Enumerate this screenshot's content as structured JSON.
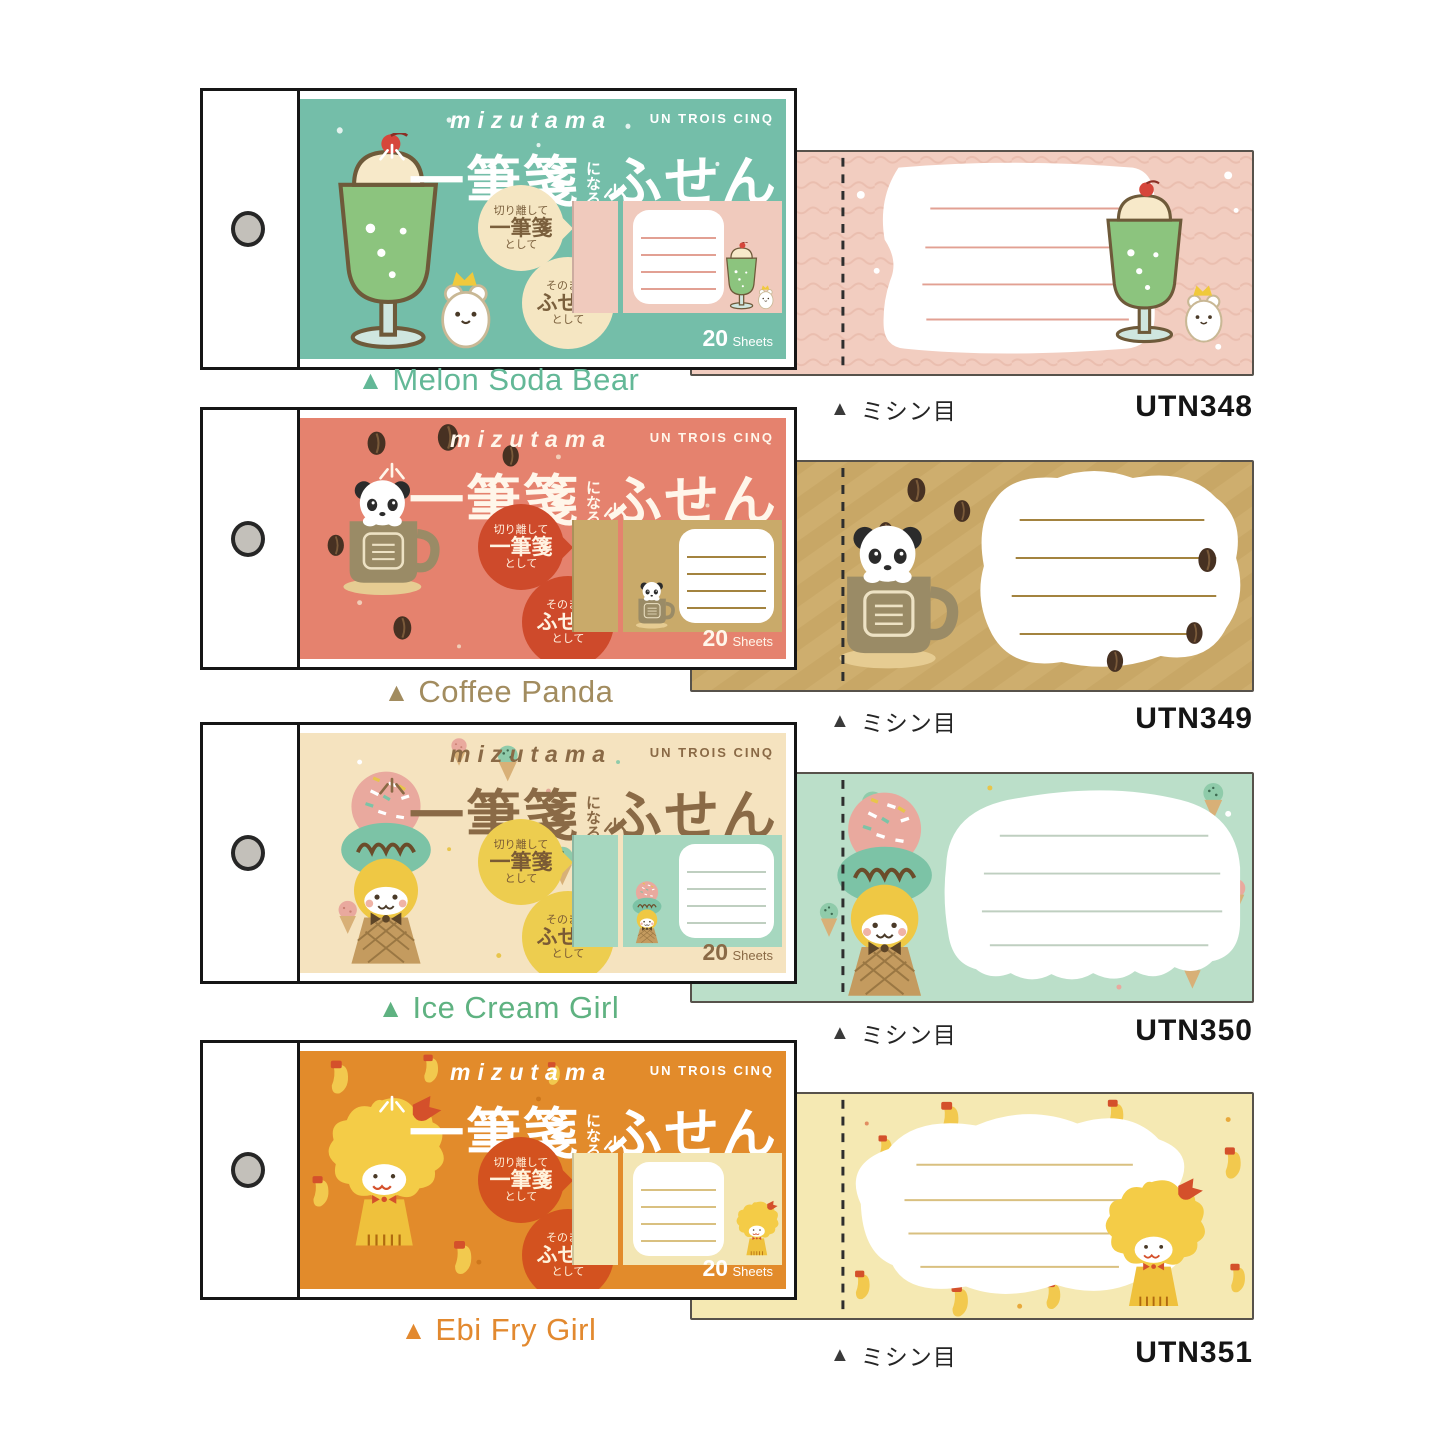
{
  "icons": {
    "triangle": "▲",
    "sparkle": "sparkle-rays",
    "binding_hole": "punch-hole"
  },
  "brand": {
    "logo": "mizutama",
    "collection": "UN TROIS CINQ"
  },
  "cover": {
    "title_part1": "一筆箋",
    "title_connector": "になる",
    "title_part2": "ふせん",
    "bubble1_line1": "切り離して",
    "bubble1_line2": "一筆箋",
    "bubble1_line3": "として",
    "bubble2_line1": "そのまま",
    "bubble2_line2": "ふせん",
    "bubble2_line3": "として",
    "sheets_count": "20",
    "sheets_label": "Sheets"
  },
  "note": {
    "perforation_label": "ミシン目"
  },
  "products": [
    {
      "name": "Melon Soda Bear",
      "code": "UTN348",
      "colors": {
        "cover_bg": "#74BEA9",
        "ink": "#FFFFFF",
        "bubble_bg": "#F5E6C2",
        "bubble_ink": "#7A5F3C",
        "label": "#63B897",
        "note_bg": "#F2CDC0",
        "note_line": "#E2A093",
        "preview_bg": "#F0CABD"
      }
    },
    {
      "name": "Coffee Panda",
      "code": "UTN349",
      "colors": {
        "cover_bg": "#E5826E",
        "ink": "#FFF6EA",
        "bubble_bg": "#CE4A2B",
        "bubble_ink": "#FFF3E2",
        "label": "#A28C5F",
        "note_bg": "#C8A766",
        "note_line": "#A3833F",
        "preview_bg": "#C9AA6A"
      }
    },
    {
      "name": "Ice Cream Girl",
      "code": "UTN350",
      "colors": {
        "cover_bg": "#F5E3BF",
        "ink": "#8A6A46",
        "bubble_bg": "#EDCD4F",
        "bubble_ink": "#7A5A35",
        "label": "#5FB281",
        "note_bg": "#BBDFC9",
        "note_line": "#BFCFC0",
        "preview_bg": "#A6D7BF"
      }
    },
    {
      "name": "Ebi Fry Girl",
      "code": "UTN351",
      "colors": {
        "cover_bg": "#E28B2B",
        "ink": "#FFFFFF",
        "bubble_bg": "#D3521F",
        "bubble_ink": "#FFF3DC",
        "label": "#E2892F",
        "note_bg": "#F5E9B3",
        "note_line": "#D9C080",
        "preview_bg": "#F3E6B4"
      }
    }
  ]
}
